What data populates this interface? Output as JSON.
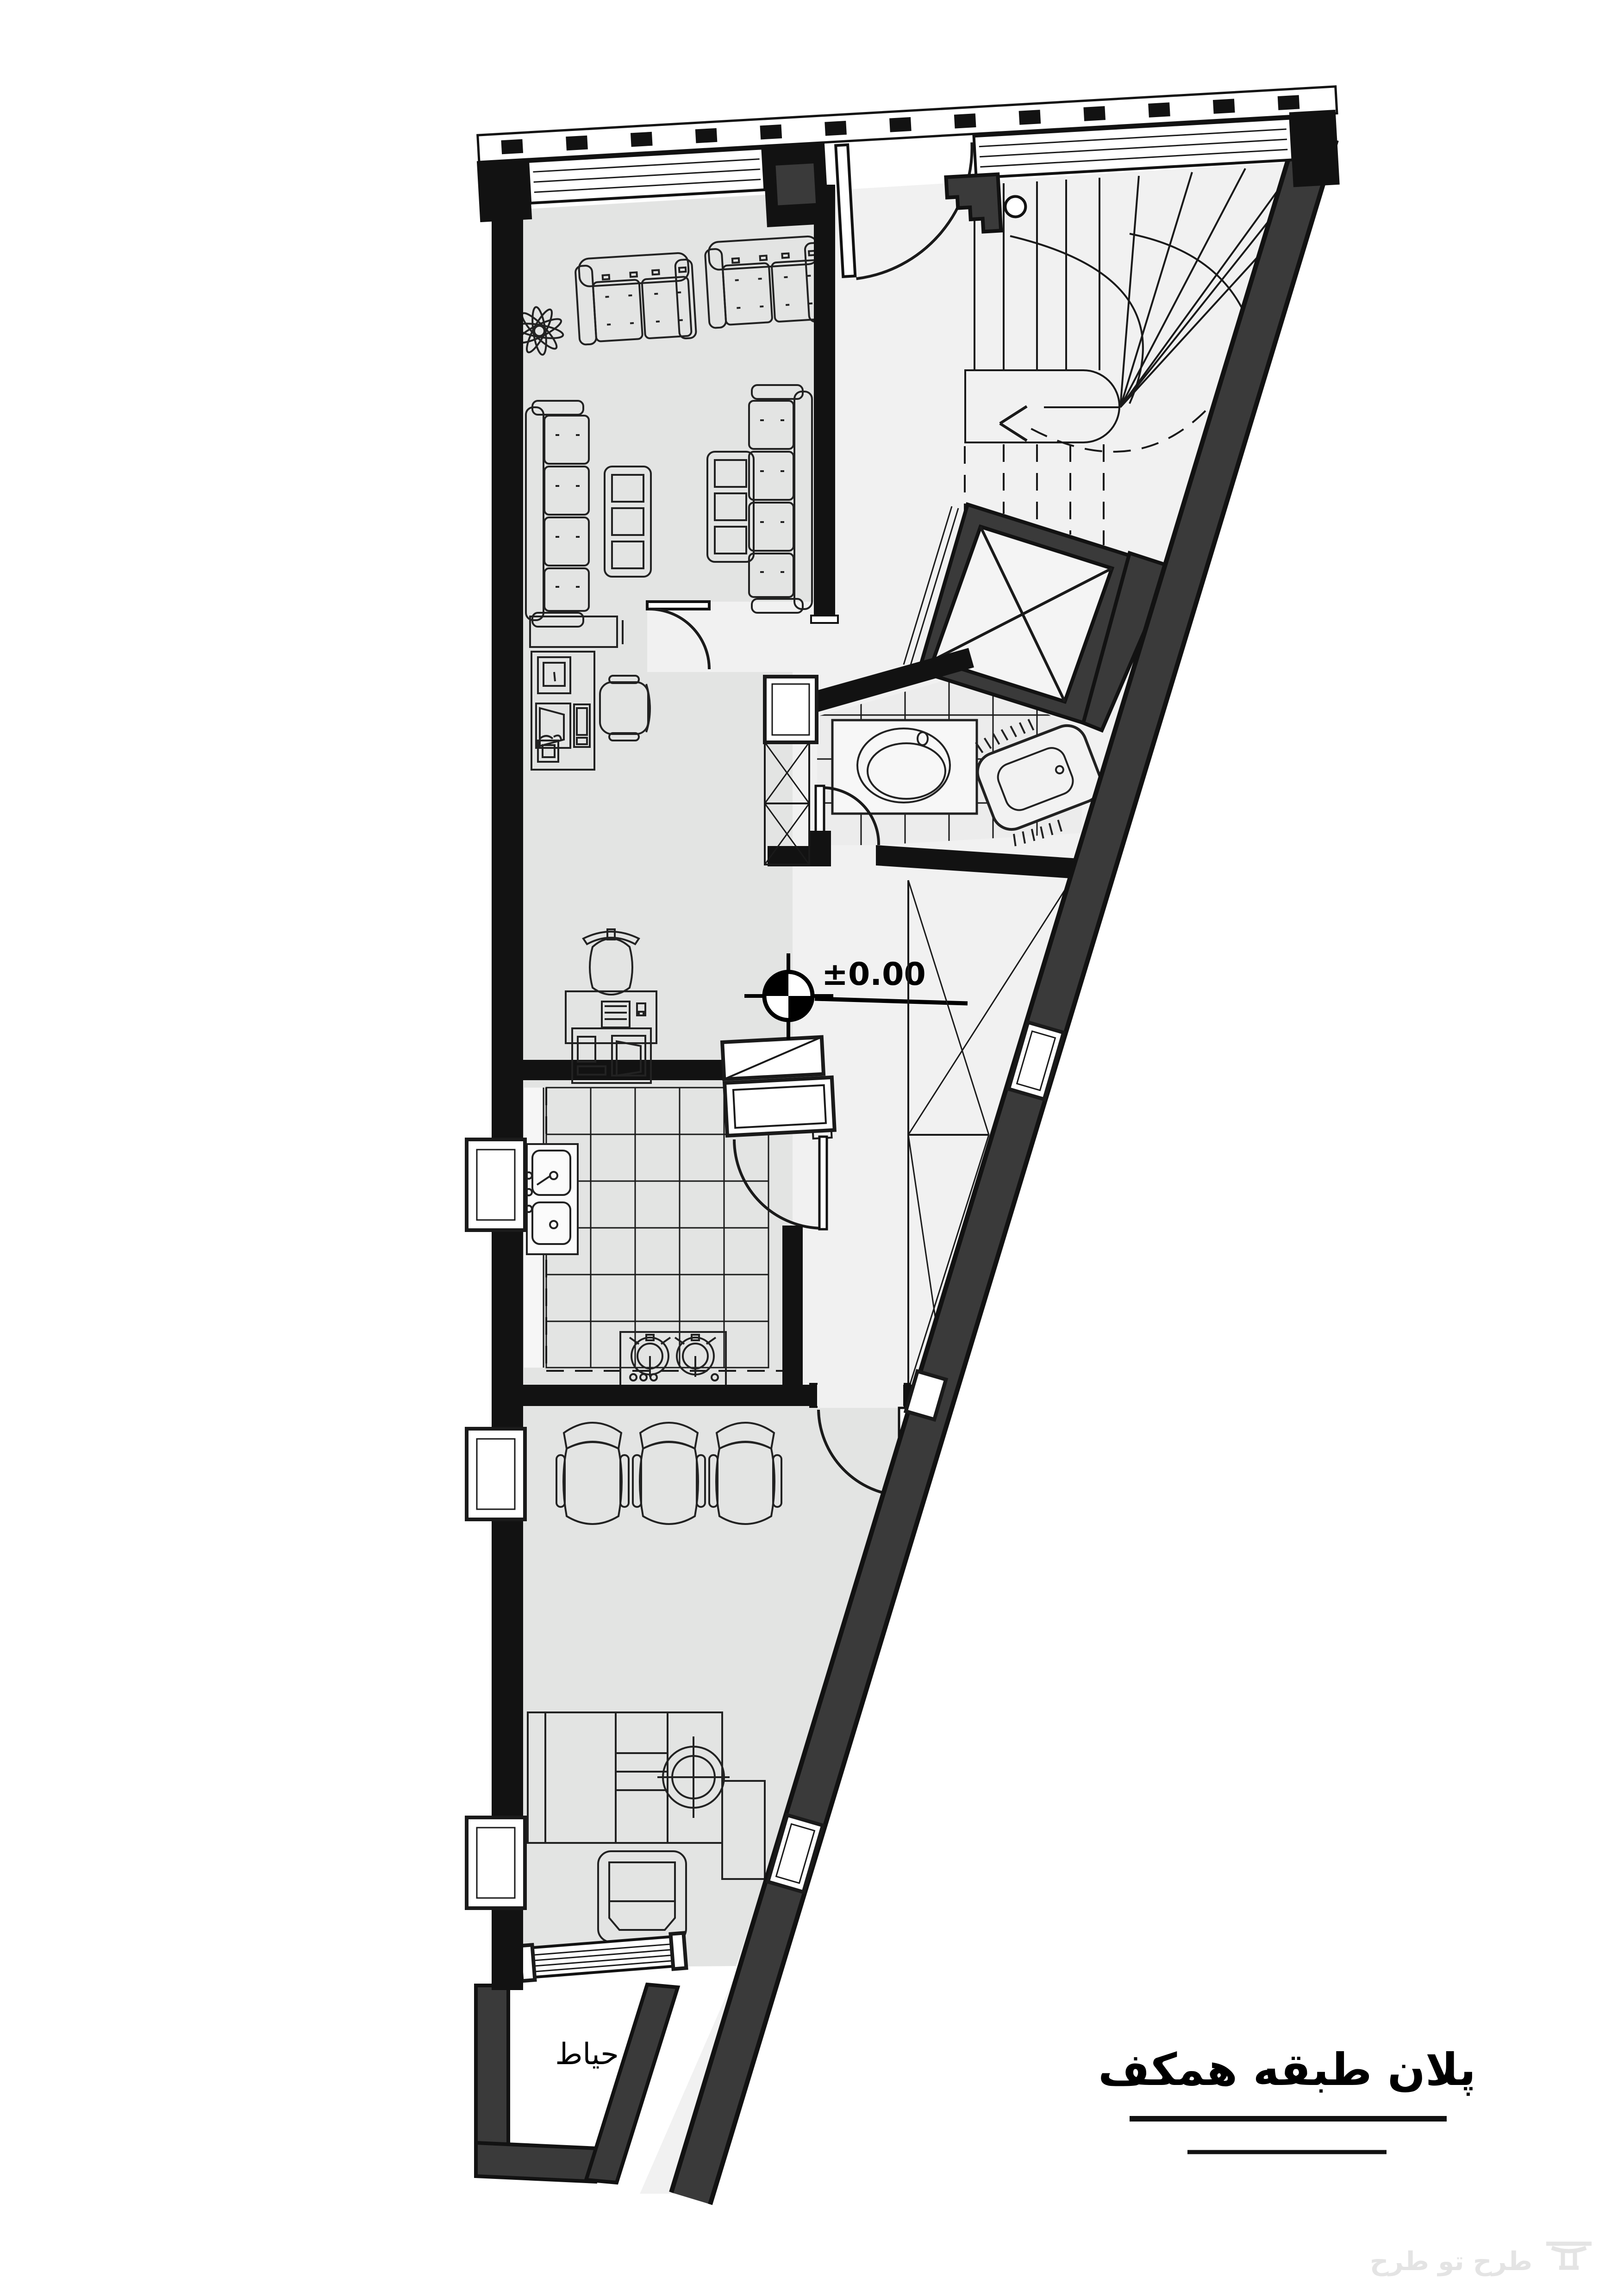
{
  "title": {
    "text": "پلان طبقه همکف"
  },
  "labels": {
    "courtyard": "حیاط",
    "level": "±0.00"
  },
  "watermark": {
    "text": "طرح تو طرح"
  },
  "drawing": {
    "type": "architectural-floor-plan",
    "floor": "ground floor",
    "rooms": [
      "reception-lounge",
      "office-area",
      "kitchen",
      "bathroom",
      "stairwell",
      "elevator-shaft",
      "duct-shaft",
      "light-well",
      "hallway",
      "living-room",
      "courtyard"
    ],
    "furniture": [
      "two-seat-sofa",
      "two-seat-sofa",
      "long-sofa-left",
      "long-sofa-right",
      "coffee-table",
      "coffee-table",
      "plant",
      "desk-with-computer",
      "office-chair",
      "printer-copier-desk",
      "kitchen-sink",
      "stove-two-burner",
      "refrigerator-cabinet",
      "vanity-sink",
      "squat-toilet",
      "guest-chair",
      "guest-chair",
      "guest-chair",
      "work-desk",
      "armchair"
    ],
    "symbols": [
      "level-marker",
      "stair-up-fan",
      "stair-down-dashed-arrow",
      "door-swings",
      "window-bands"
    ]
  },
  "colors": {
    "wall": "#121212",
    "wall_dark": "#3a3a3a",
    "room_fill": "#e3e4e3",
    "circulation_fill": "#f1f1f1",
    "tile_fill": "#ececec",
    "background": "#ffffff",
    "watermark": "#e4e4e4"
  }
}
